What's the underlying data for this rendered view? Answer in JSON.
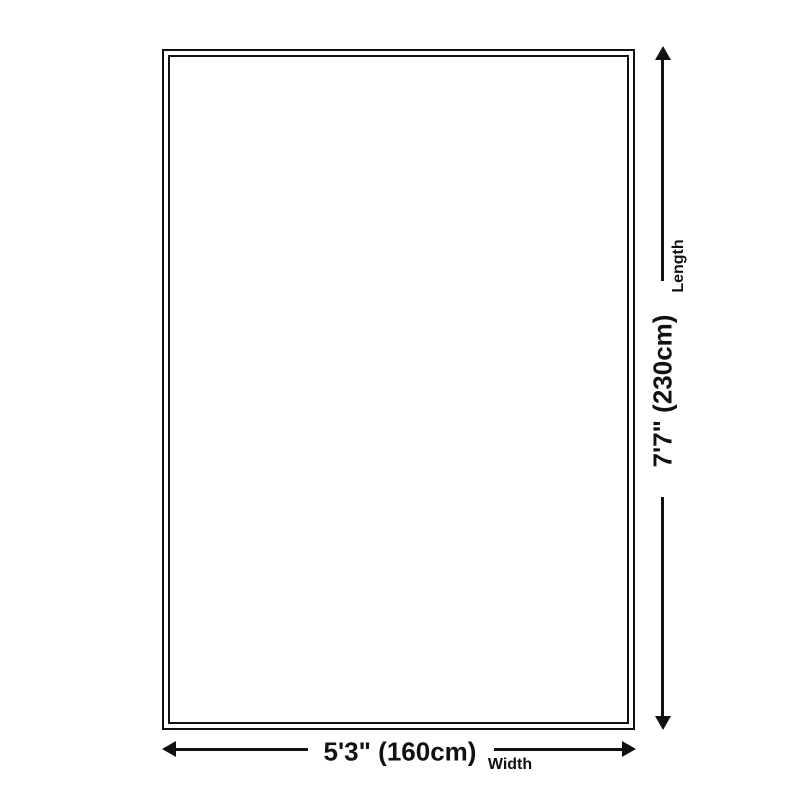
{
  "diagram": {
    "type": "product-size-diagram",
    "vertical_axis": {
      "label": "Length",
      "value": "7'7\" (230cm)"
    },
    "horizontal_axis": {
      "label": "Width",
      "value": "5'3\" (160cm)"
    },
    "colors": {
      "line": "#111111",
      "background": "#ffffff"
    }
  }
}
